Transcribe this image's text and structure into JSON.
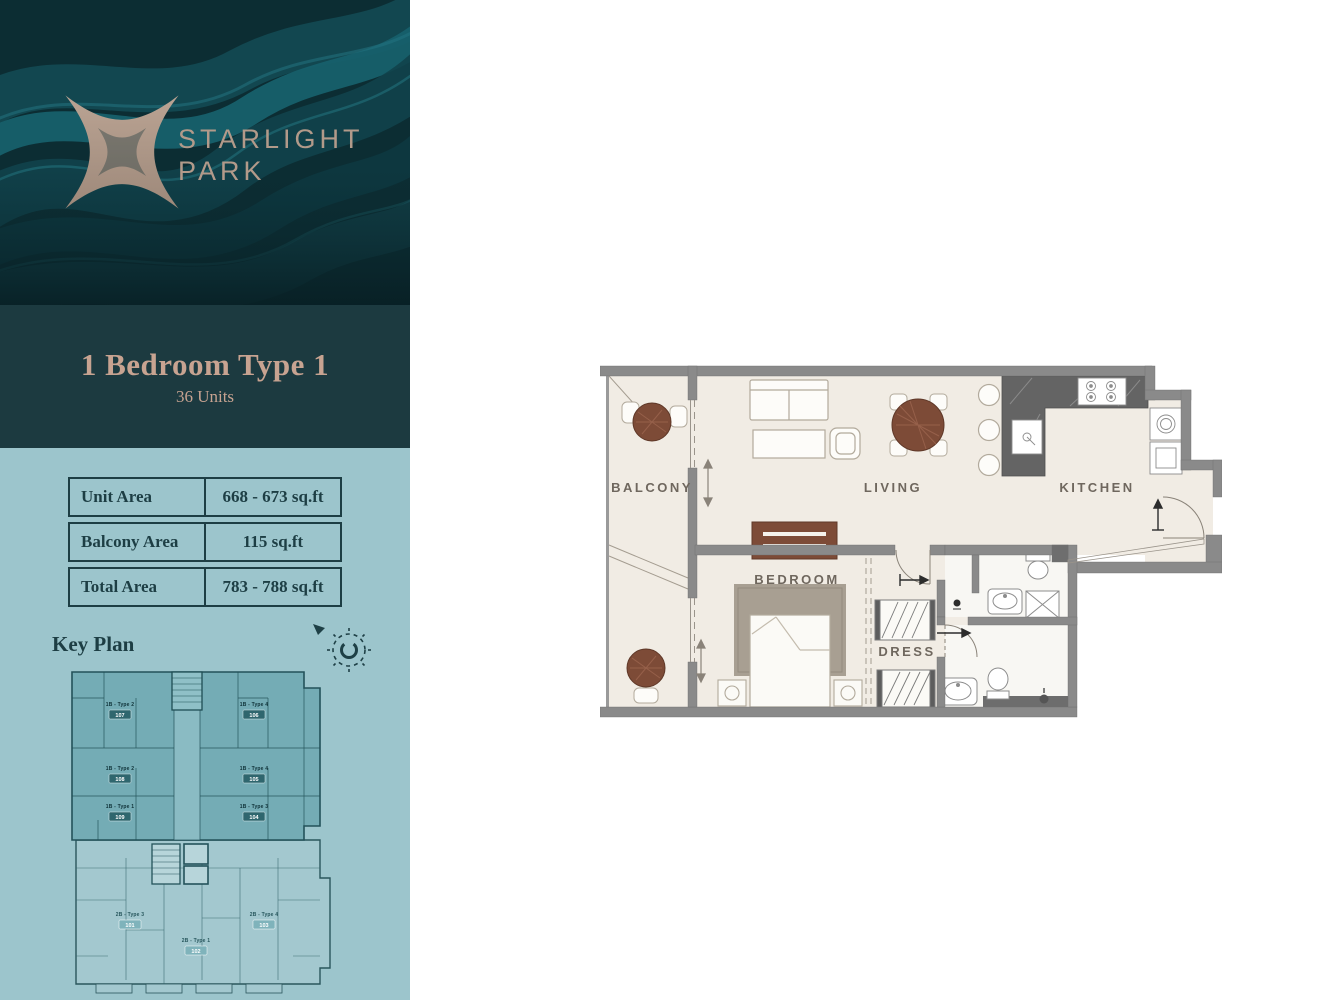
{
  "colors": {
    "hero_teal_dark": "#0b2b31",
    "panel_teal": "#1c3a40",
    "panel_blue": "#9cc5cc",
    "accent_tan": "#c7a391",
    "logo_tan": "#b29a8a",
    "ink_teal": "#1d3e44",
    "wall_gray": "#8a8a8a",
    "floor_cream": "#f1ece4",
    "bath_white": "#f8f7f3",
    "wood_brown": "#7d4b37",
    "counter_gray": "#646464",
    "label_gray": "#6f675e",
    "keyplan_highlight": "#74acb5",
    "keyplan_line": "#23525a",
    "unitbox_teal": "#2f666e"
  },
  "sidebar": {
    "brand": {
      "name_line1": "STARLIGHT",
      "name_line2": "PARK"
    },
    "unit_header": {
      "title": "1 Bedroom Type 1",
      "subtitle": "36 Units"
    },
    "area_table": {
      "rows": [
        {
          "label": "Unit Area",
          "value": "668 - 673 sq.ft"
        },
        {
          "label": "Balcony Area",
          "value": "115 sq.ft"
        },
        {
          "label": "Total Area",
          "value": "783 - 788 sq.ft"
        }
      ]
    },
    "key_plan": {
      "heading": "Key Plan",
      "units": [
        {
          "type": "1B - Type 2",
          "number": "107"
        },
        {
          "type": "1B - Type 4",
          "number": "106"
        },
        {
          "type": "1B - Type 2",
          "number": "108"
        },
        {
          "type": "1B - Type 4",
          "number": "105"
        },
        {
          "type": "1B - Type 1",
          "number": "109"
        },
        {
          "type": "1B - Type 3",
          "number": "104"
        },
        {
          "type": "2B - Type 3",
          "number": "101"
        },
        {
          "type": "2B - Type 1",
          "number": "102"
        },
        {
          "type": "2B - Type 4",
          "number": "103"
        }
      ]
    }
  },
  "floor_plan": {
    "rooms": {
      "balcony": "BALCONY",
      "living": "LIVING",
      "kitchen": "KITCHEN",
      "bedroom": "BEDROOM",
      "dress": "DRESS"
    }
  }
}
